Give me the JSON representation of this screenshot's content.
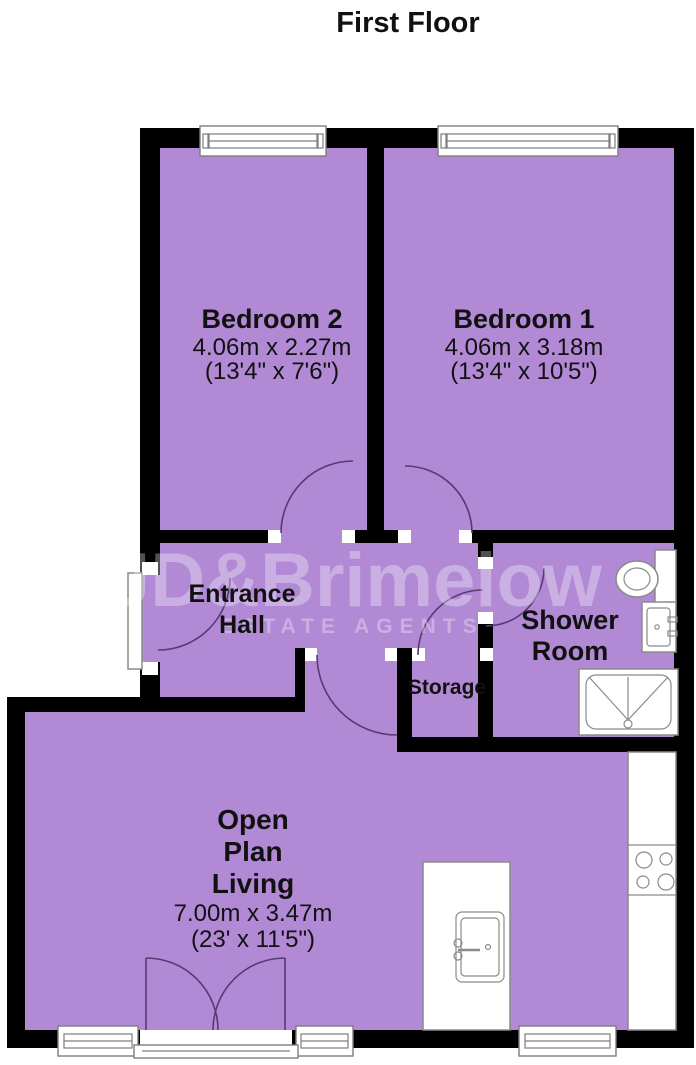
{
  "title": "First Floor",
  "watermark": {
    "brand": "JD&Brimelow",
    "tagline": "ESTATE AGENTS"
  },
  "rooms": {
    "bedroom2": {
      "name": "Bedroom 2",
      "metric": "4.06m x 2.27m",
      "imperial": "(13'4\" x 7'6\")"
    },
    "bedroom1": {
      "name": "Bedroom 1",
      "metric": "4.06m x 3.18m",
      "imperial": "(13'4\" x 10'5\")"
    },
    "entrance_hall": {
      "line1": "Entrance",
      "line2": "Hall"
    },
    "shower_room": {
      "line1": "Shower",
      "line2": "Room"
    },
    "storage": {
      "name": "Storage"
    },
    "open_plan_living": {
      "line1": "Open",
      "line2": "Plan",
      "line3": "Living",
      "metric": "7.00m x 3.47m",
      "imperial": "(23' x 11'5\")"
    }
  },
  "fixtures": [
    "toilet",
    "wash-basin",
    "shower-tray",
    "island-sink",
    "hob",
    "kitchen-counter"
  ],
  "colors": {
    "floor": "#b289d5",
    "wall": "#000000",
    "door_arc": "#583a72",
    "fixture_outline": "#8a8a8a",
    "watermark": "rgba(255,255,255,0.32)"
  }
}
